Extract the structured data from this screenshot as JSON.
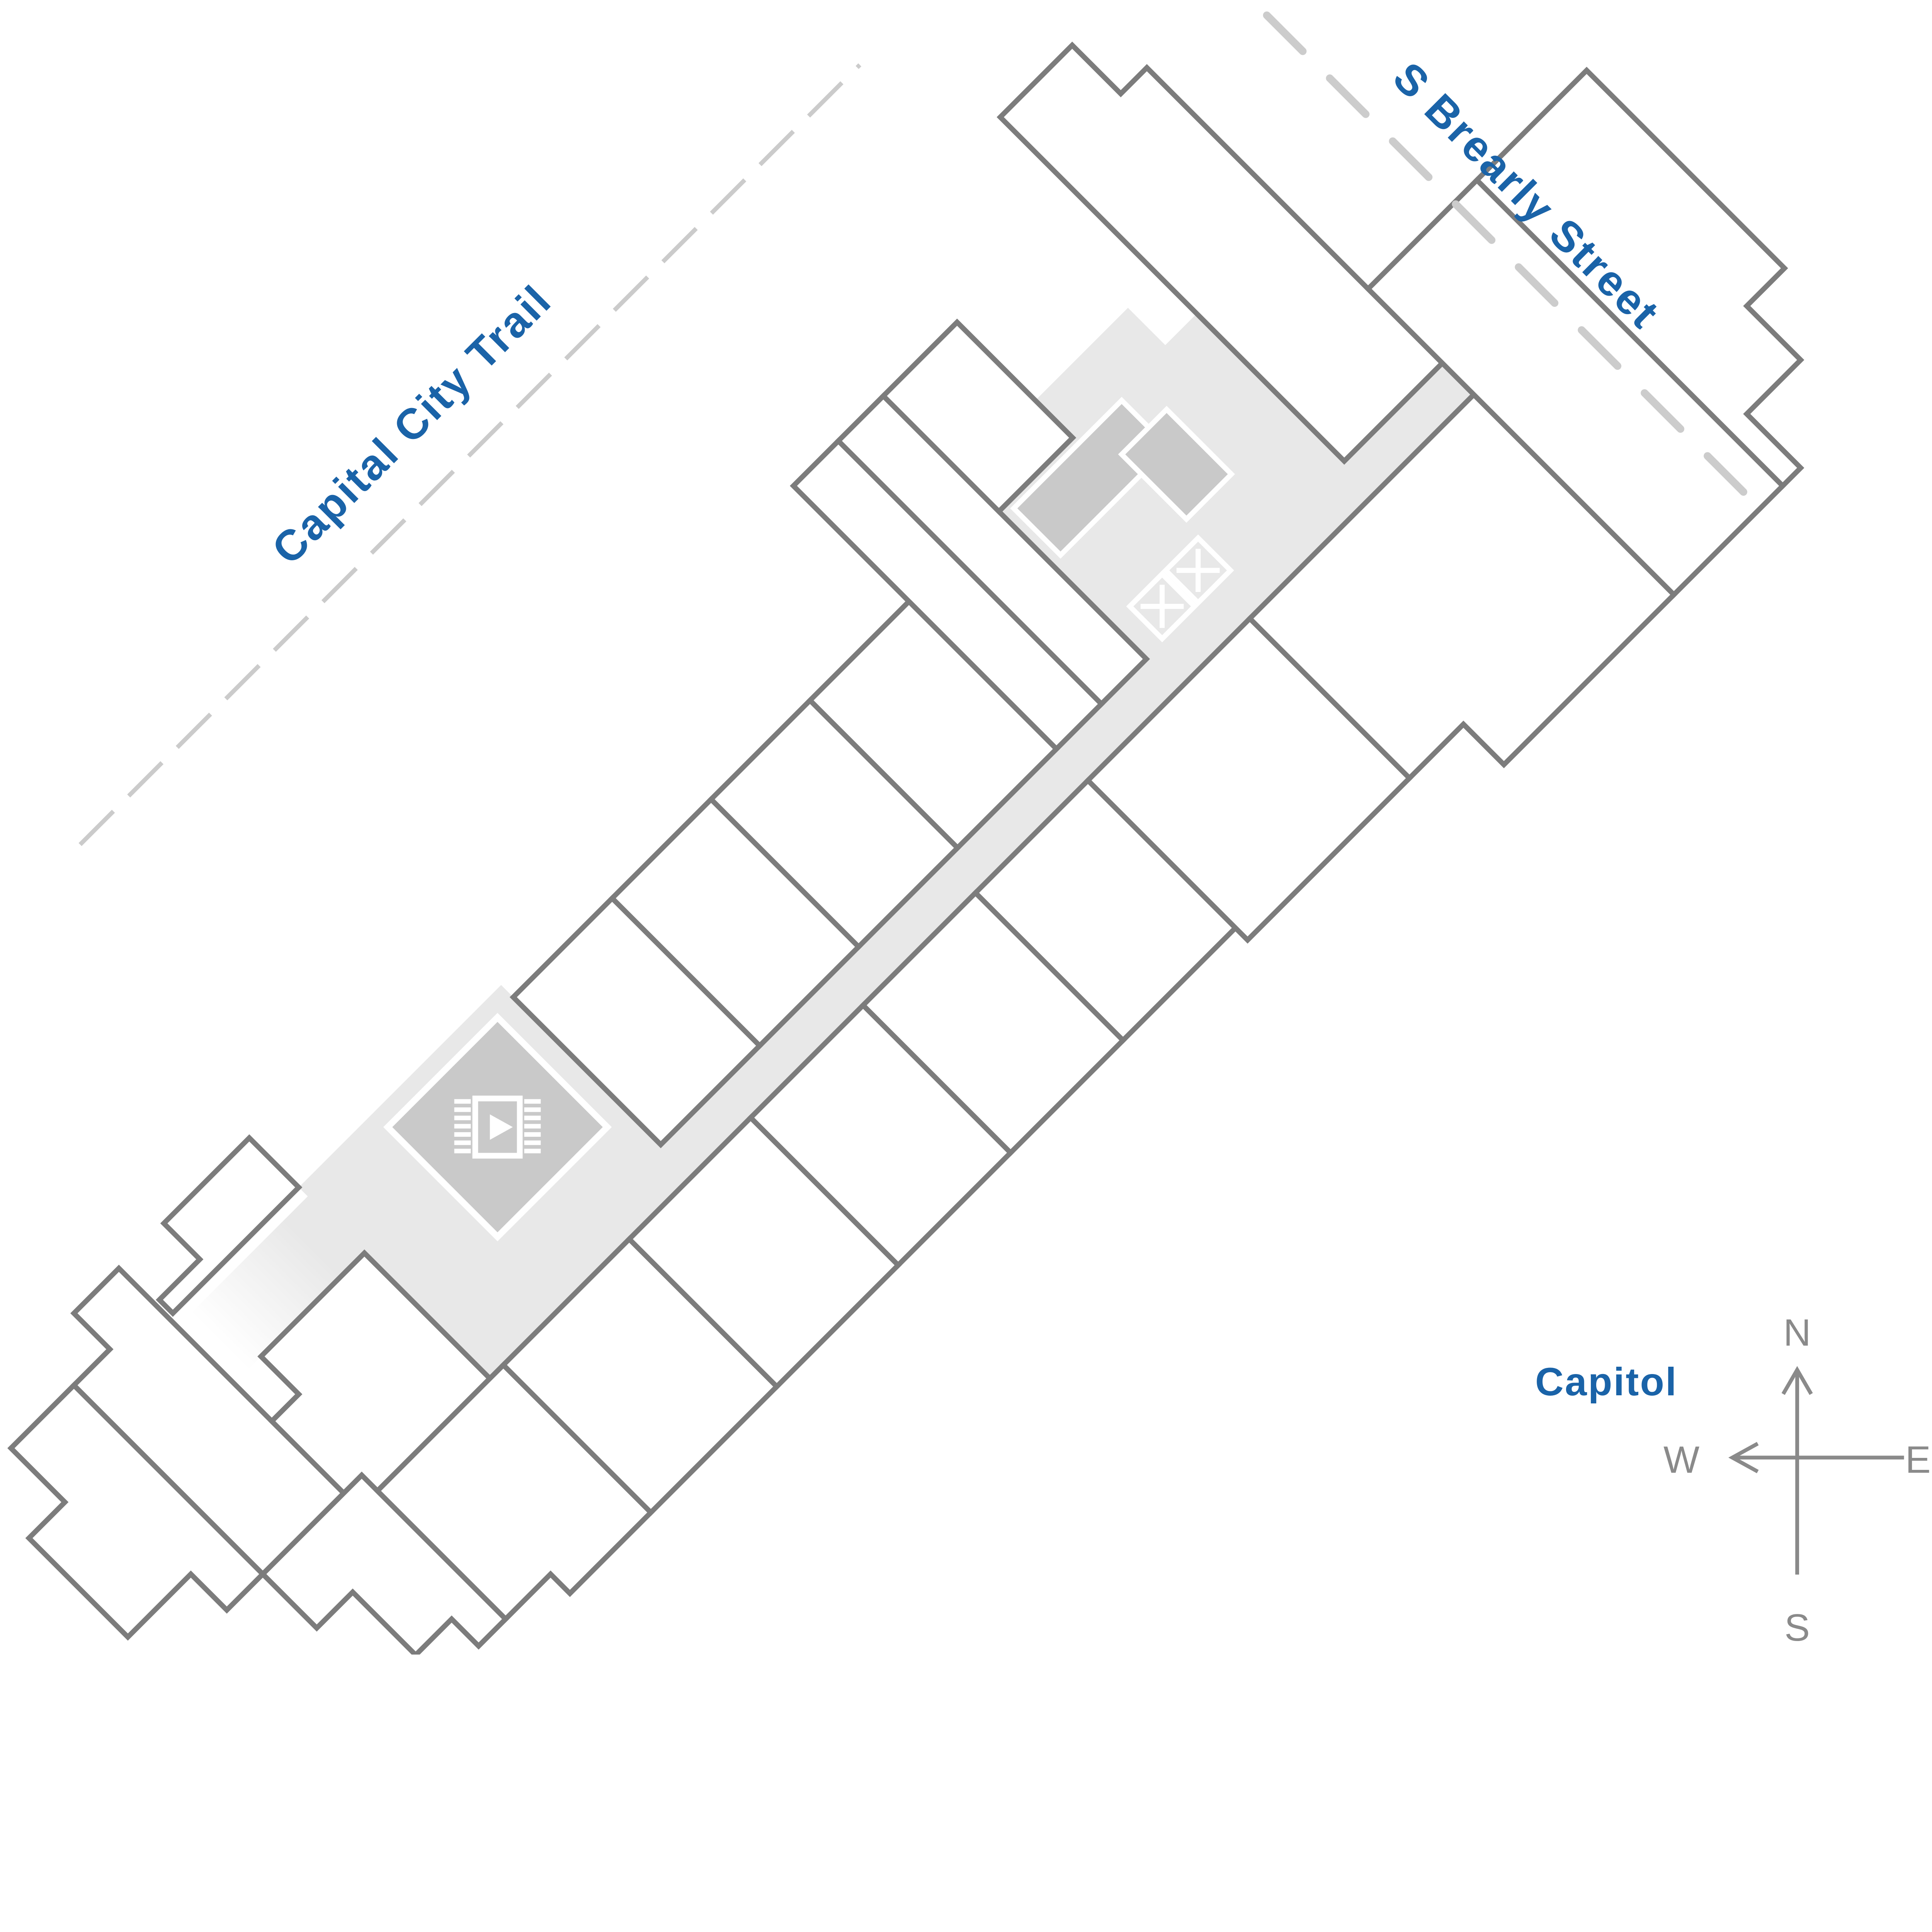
{
  "labels": {
    "trail": "Capital City Trail",
    "street": "S Brearly Street",
    "landmark": "Capitol"
  },
  "compass": {
    "north": "N",
    "east": "E",
    "south": "S",
    "west": "W"
  },
  "colors": {
    "highlight_blue": "#0e5ea6",
    "label_blue": "#1a63a8",
    "corridor_gray": "#e8e8e8",
    "amenity_gray": "#c9c9c9",
    "wall_gray": "#7c7c7c",
    "dash_gray": "#cbcbcb",
    "compass_gray": "#8a8a8a"
  },
  "icons": {
    "amenity": "video-play-icon",
    "elevators": "elevator-x-icon"
  }
}
